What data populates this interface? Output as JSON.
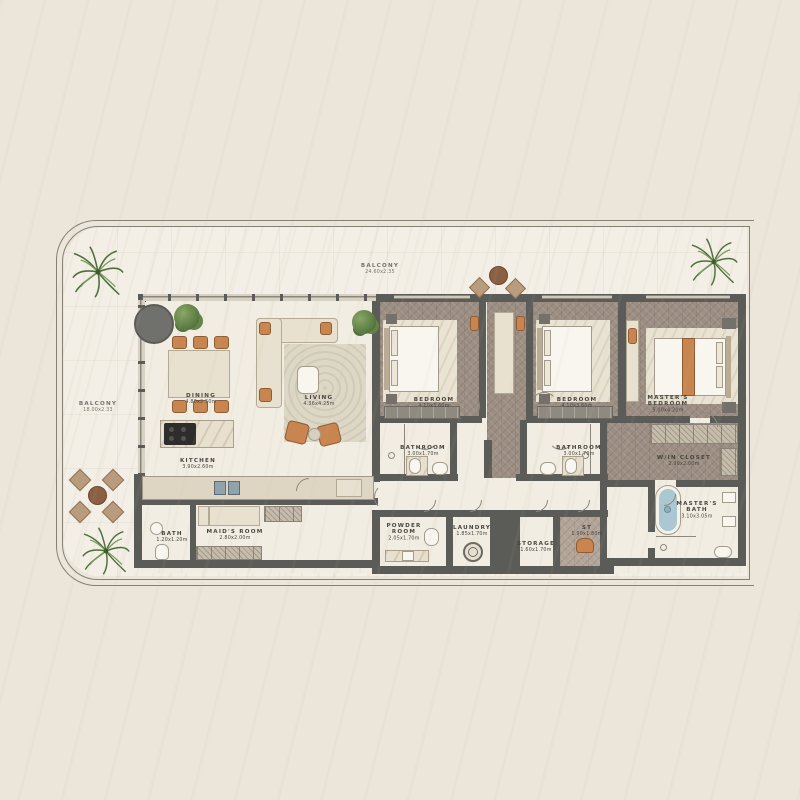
{
  "plan": {
    "balcony_top": {
      "name": "BALCONY",
      "dims": "24.60x2.35"
    },
    "balcony_left": {
      "name": "BALCONY",
      "dims": "18.00x2.33"
    },
    "rooms": {
      "dining": {
        "name": "DINING",
        "dims": "4.80x2.50m"
      },
      "living": {
        "name": "LIVING",
        "dims": "4.36x4.25m"
      },
      "kitchen": {
        "name": "KITCHEN",
        "dims": "3.90x2.60m"
      },
      "maids_room": {
        "name": "MAID'S ROOM",
        "dims": "2.80x2.00m"
      },
      "maids_bath": {
        "name": "BATH",
        "dims": "1.20x1.20m"
      },
      "bedroom_1": {
        "name": "BEDROOM",
        "dims": "4.10x3.60m"
      },
      "bedroom_2": {
        "name": "BEDROOM",
        "dims": "4.10x3.60m"
      },
      "master_bedroom": {
        "name": "MASTER'S\nBEDROOM",
        "dims": "5.00x4.20m"
      },
      "bathroom_1": {
        "name": "BATHROOM",
        "dims": "3.00x1.70m"
      },
      "bathroom_2": {
        "name": "BATHROOM",
        "dims": "3.00x1.70m"
      },
      "walk_in_closet": {
        "name": "W/IN CLOSET",
        "dims": "2.90x2.00m"
      },
      "masters_bath": {
        "name": "MASTER'S\nBATH",
        "dims": "3.10x3.05m"
      },
      "powder_room": {
        "name": "POWDER\nROOM",
        "dims": "2.05x1.70m"
      },
      "laundry": {
        "name": "LAUNDRY",
        "dims": "1.85x1.70m"
      },
      "storage": {
        "name": "STORAGE",
        "dims": "1.60x1.70m"
      },
      "st": {
        "name": "ST",
        "dims": "1.90x1.80m"
      }
    },
    "colors": {
      "wall": "#5b5b57",
      "floor_cream": "#f2ede2",
      "floor_wood": "#9c8e83",
      "balcony": "#f3efe6",
      "page_background": "#ebe5da",
      "accent_orange": "#c9854f",
      "plant_green": "#55743e",
      "tub_blue": "#aac7d2"
    }
  }
}
